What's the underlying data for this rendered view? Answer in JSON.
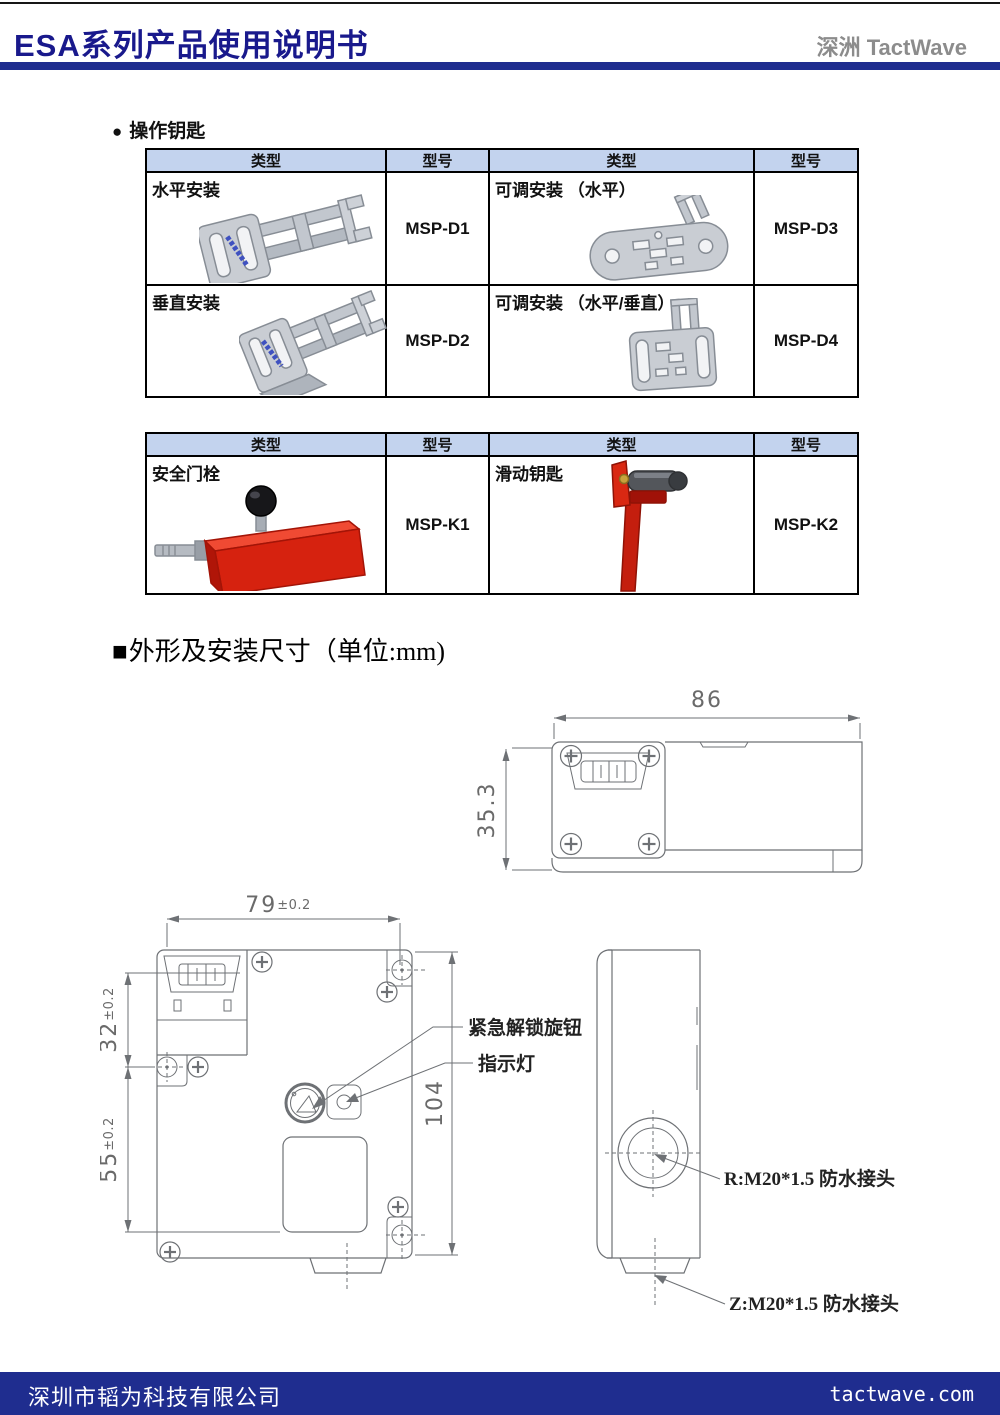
{
  "header": {
    "title": "ESA系列产品使用说明书",
    "brand": "深洲 TactWave"
  },
  "section_keys": {
    "bullet": "●",
    "title": "操作钥匙"
  },
  "table_headers": [
    "类型",
    "型号",
    "类型",
    "型号"
  ],
  "table1": {
    "rows": [
      {
        "type_l": "水平安装",
        "model_l": "MSP-D1",
        "type_r": "可调安装 （水平）",
        "model_r": "MSP-D3"
      },
      {
        "type_l": "垂直安装",
        "model_l": "MSP-D2",
        "type_r": "可调安装 （水平/垂直）",
        "model_r": "MSP-D4"
      }
    ]
  },
  "table2": {
    "rows": [
      {
        "type_l": "安全门栓",
        "model_l": "MSP-K1",
        "type_r": "滑动钥匙",
        "model_r": "MSP-K2"
      }
    ]
  },
  "section_dim": {
    "marker": "■",
    "title": "外形及安装尺寸（单位:mm)"
  },
  "drawing": {
    "dim_top_width": "86",
    "dim_top_height": "35.3",
    "dim_front_width": {
      "value": "79",
      "tol": "±0.2"
    },
    "dim_front_upper": {
      "value": "32",
      "tol": "±0.2"
    },
    "dim_front_lower": {
      "value": "55",
      "tol": "±0.2"
    },
    "dim_front_height": "104",
    "label_knob": "紧急解锁旋钮",
    "label_indicator": "指示灯",
    "label_gland_r": "R:M20*1.5 防水接头",
    "label_gland_z": "Z:M20*1.5 防水接头"
  },
  "footer": {
    "company": "深圳市韬为科技有限公司",
    "website": "tactwave.com"
  },
  "colors": {
    "accent_blue": "#1f2d8f",
    "title_navy": "#19198c",
    "brand_gray": "#8c8c8c",
    "table_header_bg": "#c3d3ee",
    "drawing_gray": "#6e7175",
    "product_red": "#d6220f",
    "product_gray": "#c9cdd3"
  }
}
